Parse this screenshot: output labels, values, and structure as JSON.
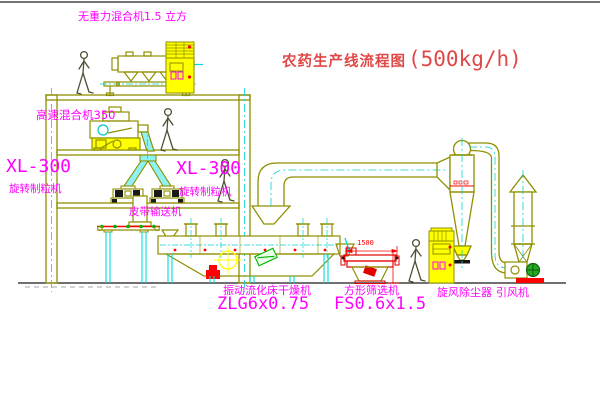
{
  "title": {
    "zh": "农药生产线流程图",
    "capacity": "(500kg/h)"
  },
  "labels": {
    "gravity_mixer": "无重力混合机1.5 立方",
    "high_speed_mixer": "高速混合机350",
    "granulator_left_model": "XL-300",
    "granulator_left_name": "旋转制粒机",
    "granulator_right_model": "XL-300",
    "granulator_right_name": "旋转制粒机",
    "belt_conveyor": "皮带输送机",
    "fluid_bed_dryer_name": "振动流化床干燥机",
    "fluid_bed_dryer_model": "ZLG6x0.75",
    "square_sieve_name": "方形筛选机",
    "square_sieve_model": "FS0.6x1.5",
    "cyclone": "旋风除尘器",
    "fan": "引风机",
    "dimension_1500": "1500"
  },
  "colors": {
    "line_olive": "#8f8f00",
    "accent_cyan": "#00d4d4",
    "fill_yellow": "#ffff00",
    "label_magenta": "#ff00ff",
    "title_red": "#e04848",
    "dim_red": "#ff0000",
    "motor_green": "#22aa22",
    "conveyor_dot_green": "#00b300"
  }
}
